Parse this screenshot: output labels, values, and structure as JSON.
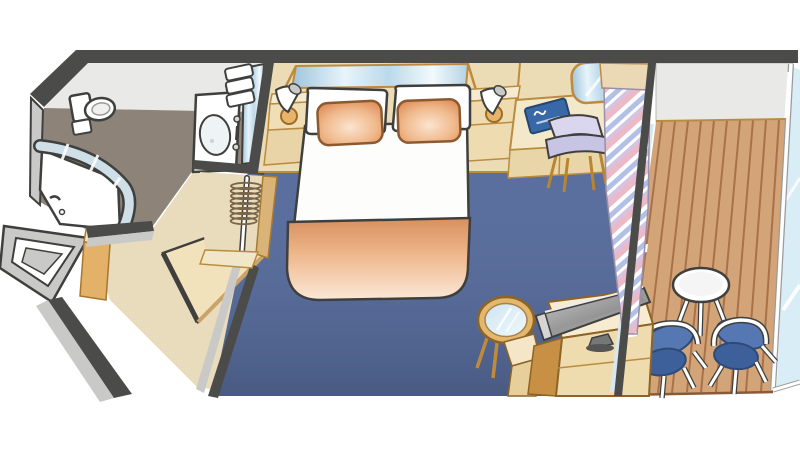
{
  "canvas": {
    "width": 800,
    "height": 450,
    "background": "#ffffff"
  },
  "diagram_type": "cruise-stateroom-floorplan",
  "areas": [
    {
      "id": "bathroom",
      "label": "Bathroom",
      "floor_color": "#8d8379"
    },
    {
      "id": "entry",
      "label": "Entry corridor and closet",
      "floor_color": "#e9dcbc"
    },
    {
      "id": "cabin",
      "label": "Main cabin",
      "floor_color": "#5b6f9e"
    },
    {
      "id": "balcony",
      "label": "Balcony",
      "floor_color": "#d2a478"
    }
  ],
  "items": {
    "top_wall": {
      "label": "Cabin wall"
    },
    "bathroom": {
      "label": "Bathroom"
    },
    "toilet": {
      "label": "Toilet"
    },
    "shower": {
      "label": "Curved shower enclosure"
    },
    "vanity": {
      "label": "Washbasin vanity"
    },
    "vanity_mirror": {
      "label": "Vanity mirror"
    },
    "towels": {
      "label": "Folded towels"
    },
    "closet": {
      "label": "Closet with hangers"
    },
    "hangers": {
      "label": "Clothes hangers on rail"
    },
    "entry_door": {
      "label": "Entry door (open)"
    },
    "shelf_unit": {
      "label": "Shelf unit"
    },
    "entry_cabinet": {
      "label": "Entry cabinet"
    },
    "carpet": {
      "label": "Main cabin carpet"
    },
    "bed": {
      "label": "Queen bed"
    },
    "pillow": {
      "label": "Pillow"
    },
    "accent_pillow": {
      "label": "Accent pillow"
    },
    "blanket": {
      "label": "Bed runner blanket"
    },
    "headboard_mirror": {
      "label": "Mirror panel above headboard"
    },
    "wall_lamp": {
      "label": "Wall lamp"
    },
    "nightstand": {
      "label": "Nightstand"
    },
    "desk": {
      "label": "Writing desk"
    },
    "desk_drawers": {
      "label": "Desk drawers"
    },
    "desk_mirror": {
      "label": "Desk mirror"
    },
    "desk_chair": {
      "label": "Desk chair"
    },
    "booklet": {
      "label": "Blue cruise-line booklet"
    },
    "coffee_table": {
      "label": "Round glass coffee table"
    },
    "tv": {
      "label": "Flat-screen TV"
    },
    "tv_cabinet": {
      "label": "TV cabinet"
    },
    "curtain": {
      "label": "Striped curtain"
    },
    "balcony_door": {
      "label": "Sliding glass balcony door"
    },
    "balcony_deck": {
      "label": "Balcony wood deck"
    },
    "balcony_table": {
      "label": "Balcony table"
    },
    "balcony_chair": {
      "label": "Balcony chair"
    },
    "railing": {
      "label": "Glass balcony railing"
    }
  },
  "colors": {
    "wall_dark": "#4b4b49",
    "wall_face": "#c9c9c7",
    "wall_inner": "#e9e9e7",
    "bath_floor": "#8d8379",
    "corridor_floor": "#e9dcbc",
    "wood_trim": "#c08a3e",
    "wood_dark": "#8d6426",
    "cabinet_top": "#f6ead0",
    "cabinet_front": "#ecd9ae",
    "carpet": "#5b6f9e",
    "deck": "#d2a478",
    "deck_groove": "#a9714a",
    "glass": "#d7e8f2",
    "curtain_pink": "#ecb9c6",
    "curtain_blue": "#b3c0e6",
    "curtain_lavender": "#d6c3e2",
    "pillow_orange": "#e39a66",
    "blanket_orange": "#eeb88c",
    "chair_blue": "#5578b2",
    "desk_chair_lavender": "#d9d6ee",
    "book_blue": "#3968a8",
    "tv_gray": "#9a9a9a"
  }
}
